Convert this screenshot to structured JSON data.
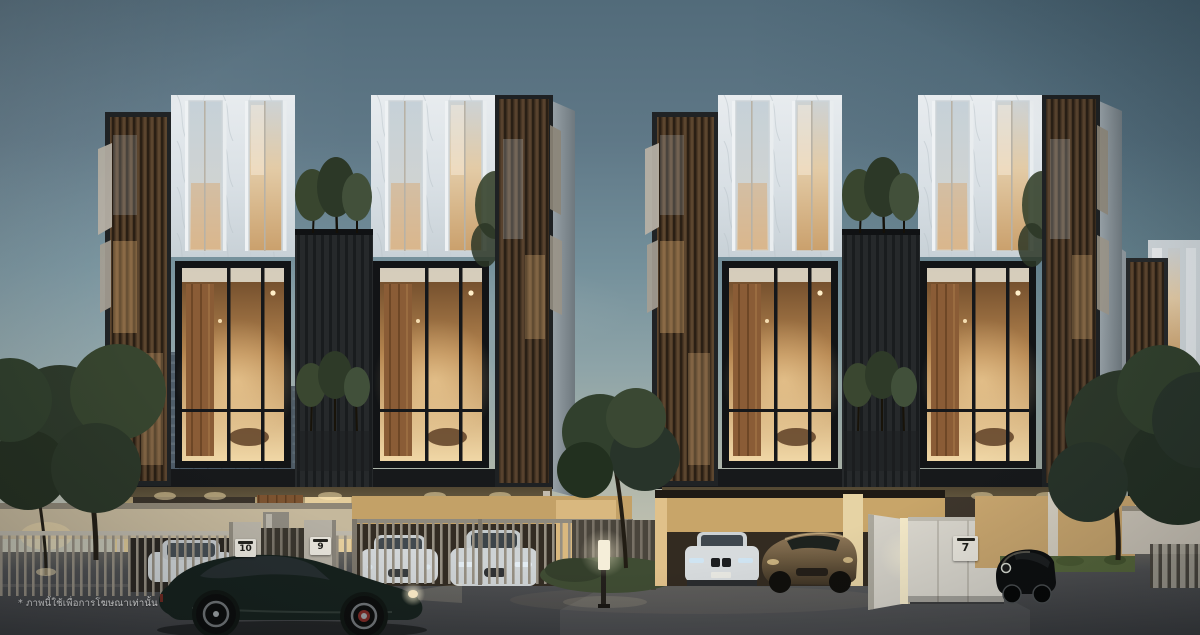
{
  "image": {
    "kind": "architectural-rendering",
    "subject": "Modern luxury townhome clusters at dusk with warm interior lighting, landscaped frontage and parked sports cars",
    "time_of_day": "dusk"
  },
  "disclaimer": {
    "text": "* ภาพนี้ใช้เพื่อการโฆษณาเท่านั้น"
  },
  "gates": {
    "unit_numbers": [
      "10",
      "9",
      "7"
    ]
  },
  "scene_objects": [
    "two mirrored townhouse clusters with marble upper facades and timber louver screens",
    "double-height warm-lit living room windows",
    "rooftop and balcony planter trees",
    "perimeter slat fence with numbered gate posts",
    "white sports cars behind driveway gates",
    "white sedan and bronze sports car in open garage",
    "dark green coupe driving on foreground road",
    "street lamp and uplights",
    "distant office tower with antennas"
  ],
  "palette": {
    "sky_top": "#526b7a",
    "sky_horizon": "#d0cbb8",
    "marble_facade": "#dde3e8",
    "dark_cladding": "#23262a",
    "warm_interior": "#eccf9f",
    "timber": "#8a6a4a",
    "road": "#46484b",
    "foliage": "#31402d"
  }
}
